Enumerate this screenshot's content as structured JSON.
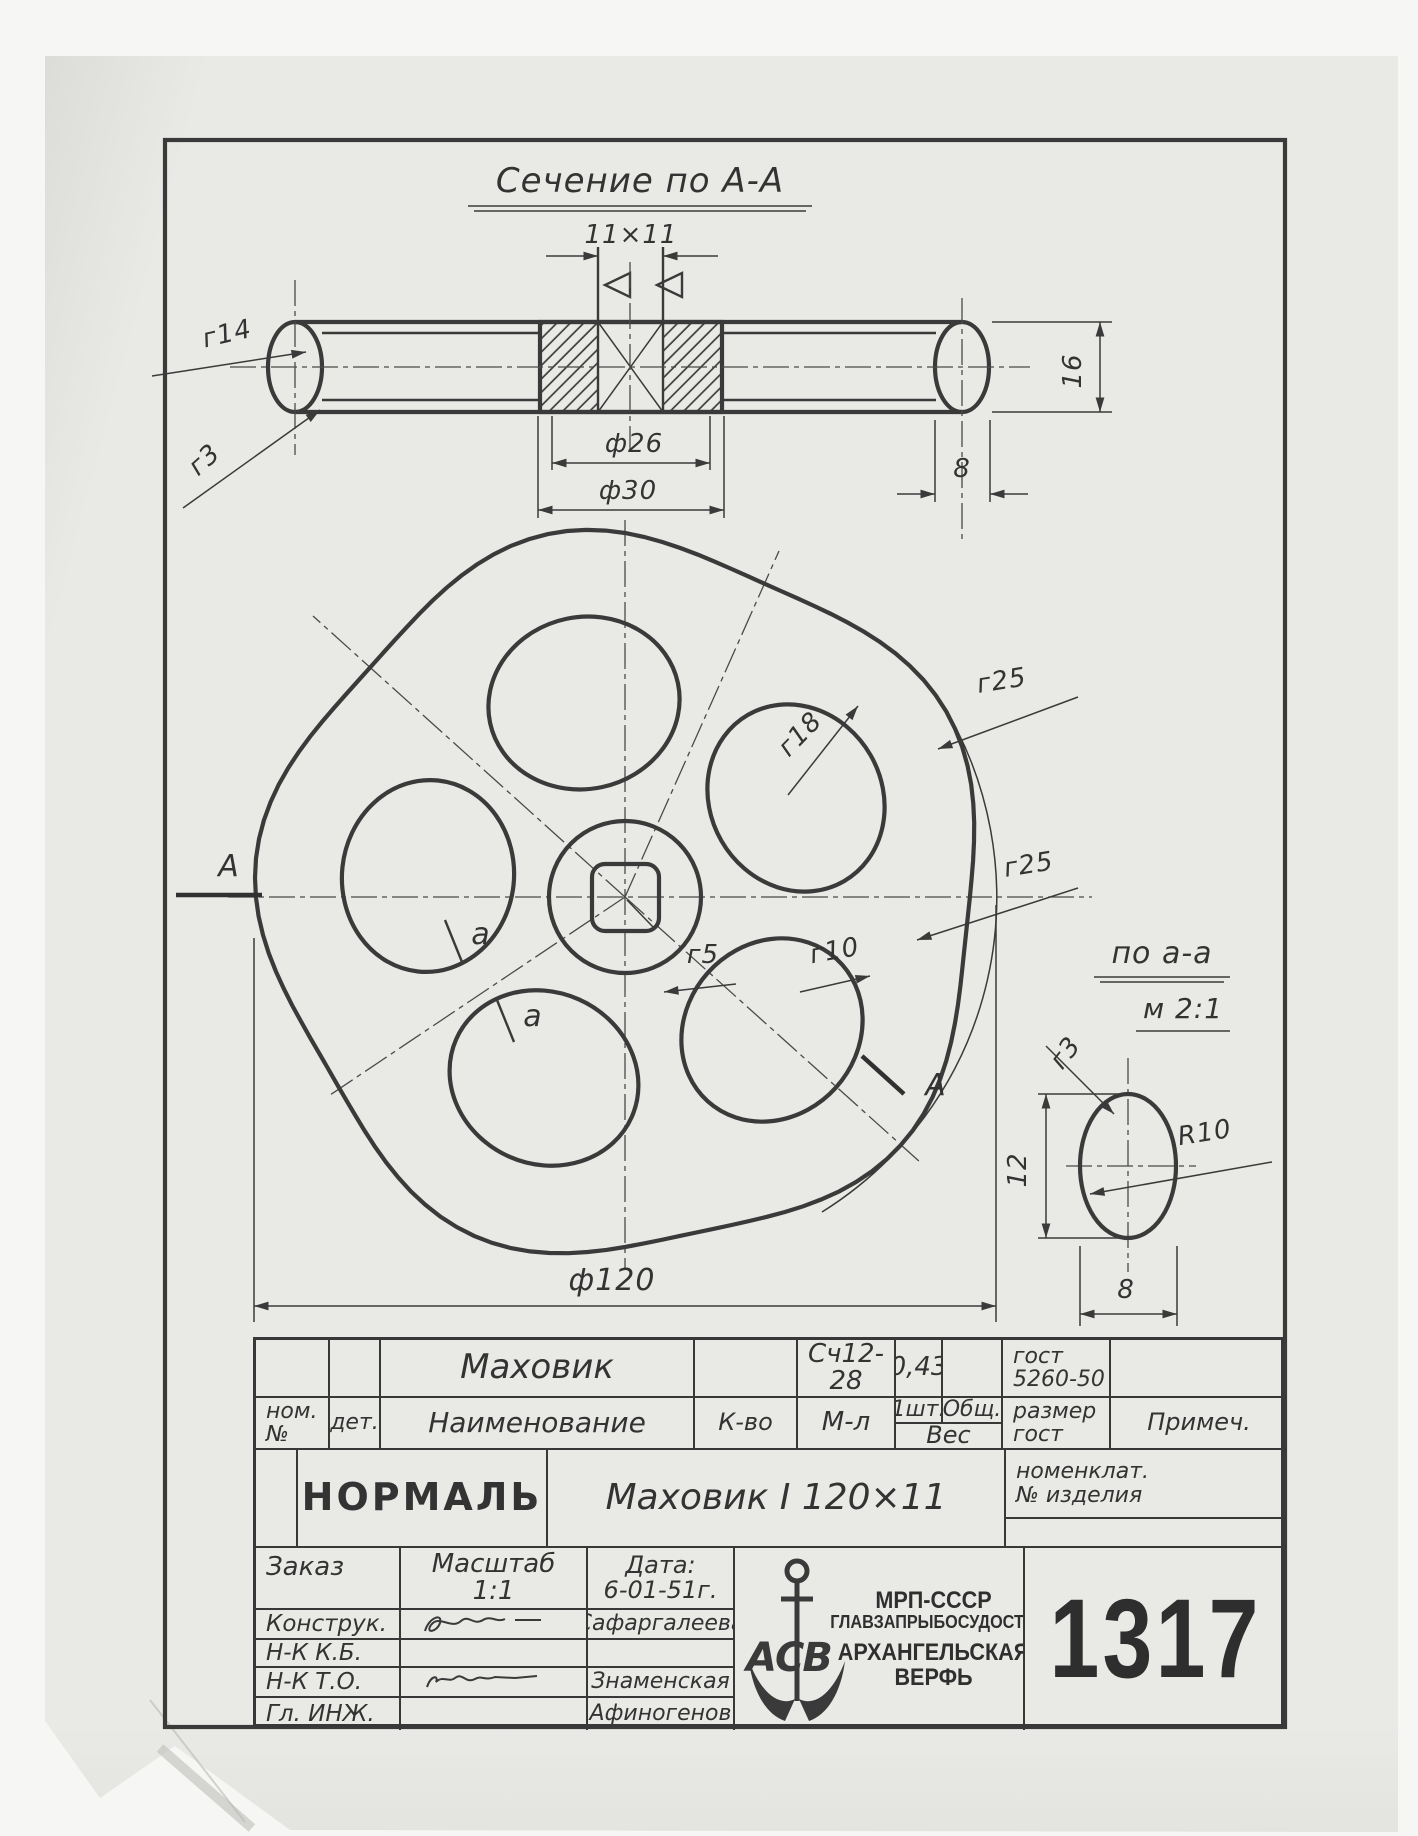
{
  "labels": {
    "section_title": "Сечение по А-А",
    "dim_11x11": "11×11",
    "r14": "г14",
    "r3_rim": "г3",
    "dia26": "ф26",
    "dia30": "ф30",
    "dim8_rim": "8",
    "dim16": "16",
    "r18": "г18",
    "r25_top": "г25",
    "r25_right": "г25",
    "r5": "г5",
    "r10": "г10",
    "dia120": "ф120",
    "section_A_left": "А",
    "section_A_right": "А",
    "cut_a_1": "а",
    "cut_a_2": "а",
    "detail_title": "по а-а",
    "detail_scale": "м 2:1",
    "r3_detail": "г3",
    "dim12": "12",
    "dim8_detail": "8",
    "R10": "R10"
  },
  "title_block": {
    "part_name": "Маховик",
    "material": "Сч12-28",
    "weight": "0,43",
    "gost_line1": "гост",
    "gost_line2": "5260-50",
    "nom_line1": "ном.",
    "nom_line2": "№",
    "det": "дет.",
    "naimenovanie": "Наименование",
    "kvo": "К-во",
    "ml": "М-л",
    "sht": "1шт.",
    "obshch": "Общ.",
    "ves": "Вес",
    "razmer_line1": "размер",
    "razmer_line2": "гост",
    "primech": "Примеч.",
    "nomenklat_line1": "номенклат.",
    "nomenklat_line2": "№ изделия",
    "normal": "НОРМАЛЬ",
    "designation": "Маховик I 120×11",
    "zakaz": "Заказ",
    "masshtab_label": "Масштаб",
    "masshtab_value": "1:1",
    "date_label": "Дата:",
    "date_value": "6-01-51г.",
    "role_konstruk": "Конструк.",
    "name_konstruk": "Сафаргалеева",
    "role_nkkb": "Н-К К.Б.",
    "role_nkto": "Н-К Т.О.",
    "name_nkto": "Знаменская",
    "role_glinzh": "Гл. ИНЖ.",
    "name_glinzh": "Афиногенов",
    "org_line1": "МРП-СССР",
    "org_line2": "ГЛАВЗАПРЫБОСУДОСТР.",
    "org_line3": "АРХАНГЕЛЬСКАЯ",
    "org_line4": "ВЕРФЬ",
    "logo_letters": "АСВ",
    "doc_number": "1317"
  },
  "colors": {
    "ink": "#3a3a3a",
    "paper": "#e9e9e6",
    "background": "#f5f5f3"
  }
}
